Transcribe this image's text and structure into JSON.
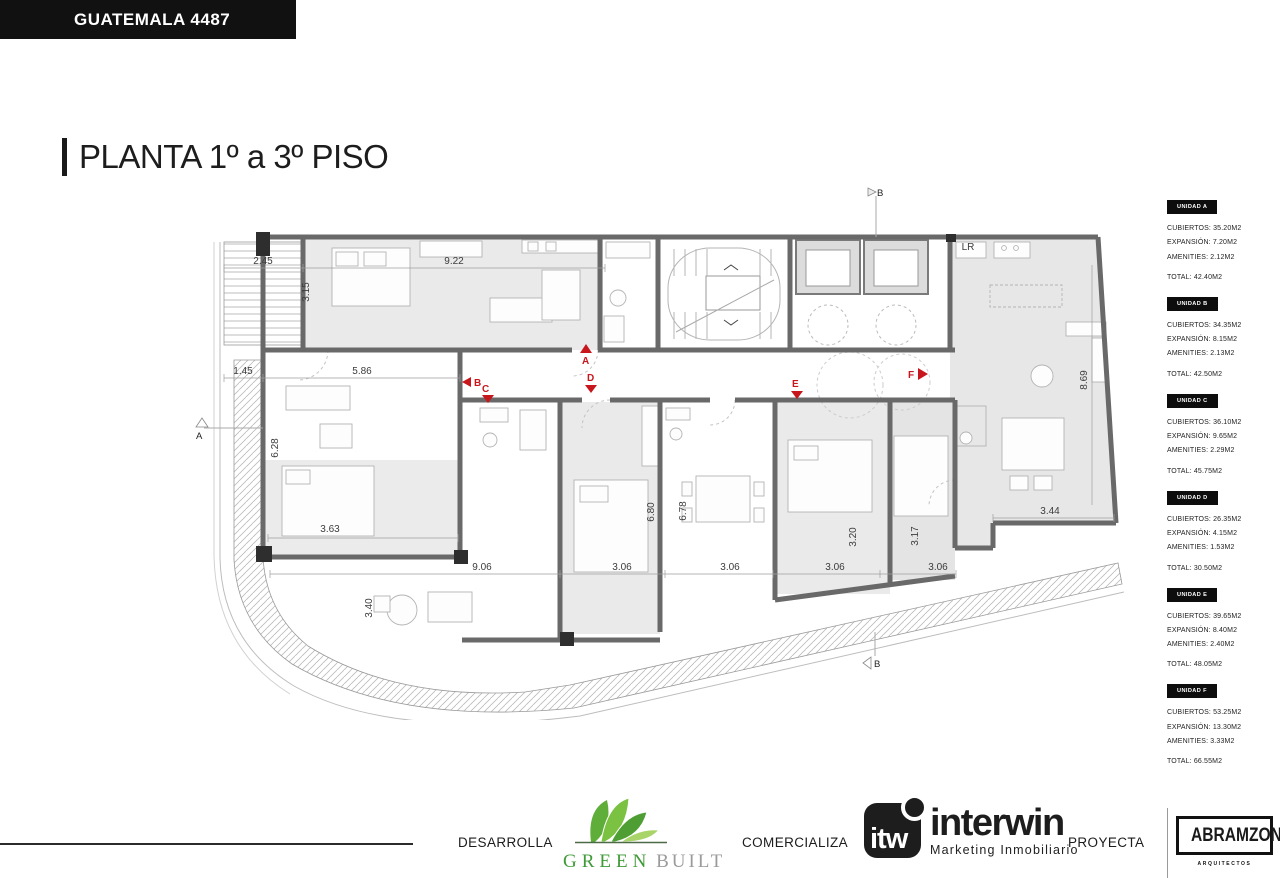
{
  "header": {
    "address": "GUATEMALA 4487"
  },
  "title": "PLANTA 1º a 3º PISO",
  "sidebar": {
    "units": [
      {
        "label": "UNIDAD A",
        "rows": [
          "CUBIERTOS: 35.20M2",
          "EXPANSIÓN: 7.20M2",
          "AMENITIES: 2.12M2"
        ],
        "total": "TOTAL: 42.40M2"
      },
      {
        "label": "UNIDAD B",
        "rows": [
          "CUBIERTOS: 34.35M2",
          "EXPANSIÓN: 8.15M2",
          "AMENITIES: 2.13M2"
        ],
        "total": "TOTAL: 42.50M2"
      },
      {
        "label": "UNIDAD C",
        "rows": [
          "CUBIERTOS: 36.10M2",
          "EXPANSIÓN: 9.65M2",
          "AMENITIES: 2.29M2"
        ],
        "total": "TOTAL: 45.75M2"
      },
      {
        "label": "UNIDAD D",
        "rows": [
          "CUBIERTOS: 26.35M2",
          "EXPANSIÓN: 4.15M2",
          "AMENITIES: 1.53M2"
        ],
        "total": "TOTAL: 30.50M2"
      },
      {
        "label": "UNIDAD E",
        "rows": [
          "CUBIERTOS: 39.65M2",
          "EXPANSIÓN: 8.40M2",
          "AMENITIES: 2.40M2"
        ],
        "total": "TOTAL: 48.05M2"
      },
      {
        "label": "UNIDAD F",
        "rows": [
          "CUBIERTOS: 53.25M2",
          "EXPANSIÓN: 13.30M2",
          "AMENITIES: 3.33M2"
        ],
        "total": "TOTAL: 66.55M2"
      }
    ]
  },
  "plan": {
    "dims": {
      "w245": "2.45",
      "w922": "9.22",
      "h315": "3.15",
      "w145": "1.45",
      "w586": "5.86",
      "h628": "6.28",
      "w363": "3.63",
      "h340": "3.40",
      "w906": "9.06",
      "w306a": "3.06",
      "w306b": "3.06",
      "w306c": "3.06",
      "w306d": "3.06",
      "h680": "6.80",
      "h678": "6.78",
      "h320": "3.20",
      "h317": "3.17",
      "w344": "3.44",
      "h869": "8.69",
      "lr": "LR"
    },
    "markers": {
      "corridor_a": "A",
      "bc_b": "B",
      "bc_c": "C",
      "d": "D",
      "e": "E",
      "f": "F",
      "section_b_top": "B",
      "section_b_bottom": "B",
      "section_a_left": "A"
    },
    "colors": {
      "wall": "#696969",
      "room_fill": "#eaeaea",
      "marker_red": "#c8161d"
    }
  },
  "footer": {
    "desarrolla": "DESARROLLA",
    "comercializa": "COMERCIALIZA",
    "proyecta": "PROYECTA",
    "greenbuilt": {
      "word1": "GREEN",
      "word2": "BUILT"
    },
    "interwin": {
      "abbr": "itw",
      "name": "interwin",
      "tagline": "Marketing Inmobiliario"
    },
    "abramzon": {
      "name": "ABRAMZON",
      "sub": "ARQUITECTOS"
    }
  }
}
